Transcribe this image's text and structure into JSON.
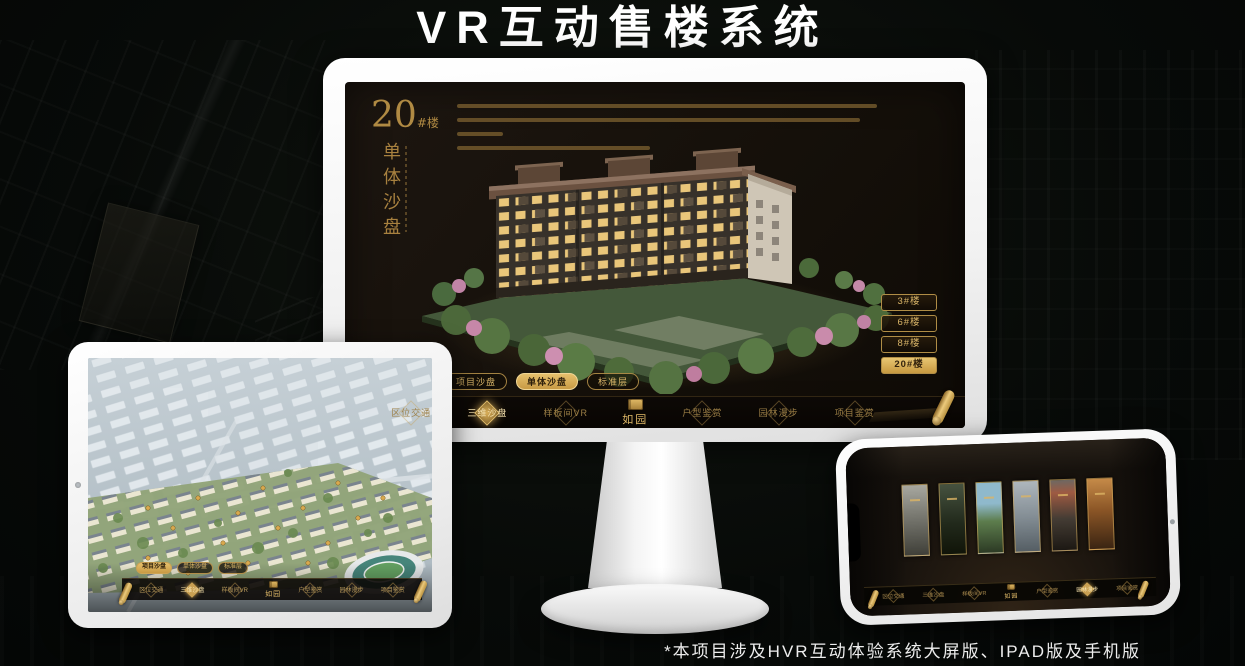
{
  "page": {
    "title": "VR互动售楼系统",
    "caption": "*本项目涉及HVR互动体验系统大屏版、IPAD版及手机版"
  },
  "colors": {
    "gold": "#c9a052",
    "gold_bright": "#e6c06c",
    "gold_deep": "#8a6a2e",
    "screen_bg": "#17100a",
    "selected_bg": "#d9ae58",
    "selected_text": "#2b1d0a"
  },
  "menu": {
    "logo": "如园",
    "items": [
      "区位交通",
      "三维沙盘",
      "样板间VR",
      "户型鉴赏",
      "园林漫步",
      "项目鉴赏"
    ],
    "tabs": [
      "项目沙盘",
      "单体沙盘",
      "标准层"
    ]
  },
  "monitor": {
    "title_number": "20",
    "title_suffix": "#楼",
    "title_vertical": "单体沙盘",
    "building_buttons": [
      "3#楼",
      "6#楼",
      "8#楼",
      "20#楼"
    ],
    "selected_building": "20#楼",
    "selected_tab": "单体沙盘",
    "highlighted_menu_item": "三维沙盘"
  },
  "tablet": {
    "selected_tab": "项目沙盘",
    "highlighted_menu_item": "三维沙盘"
  },
  "phone": {
    "highlighted_menu_item": "园林漫步"
  }
}
